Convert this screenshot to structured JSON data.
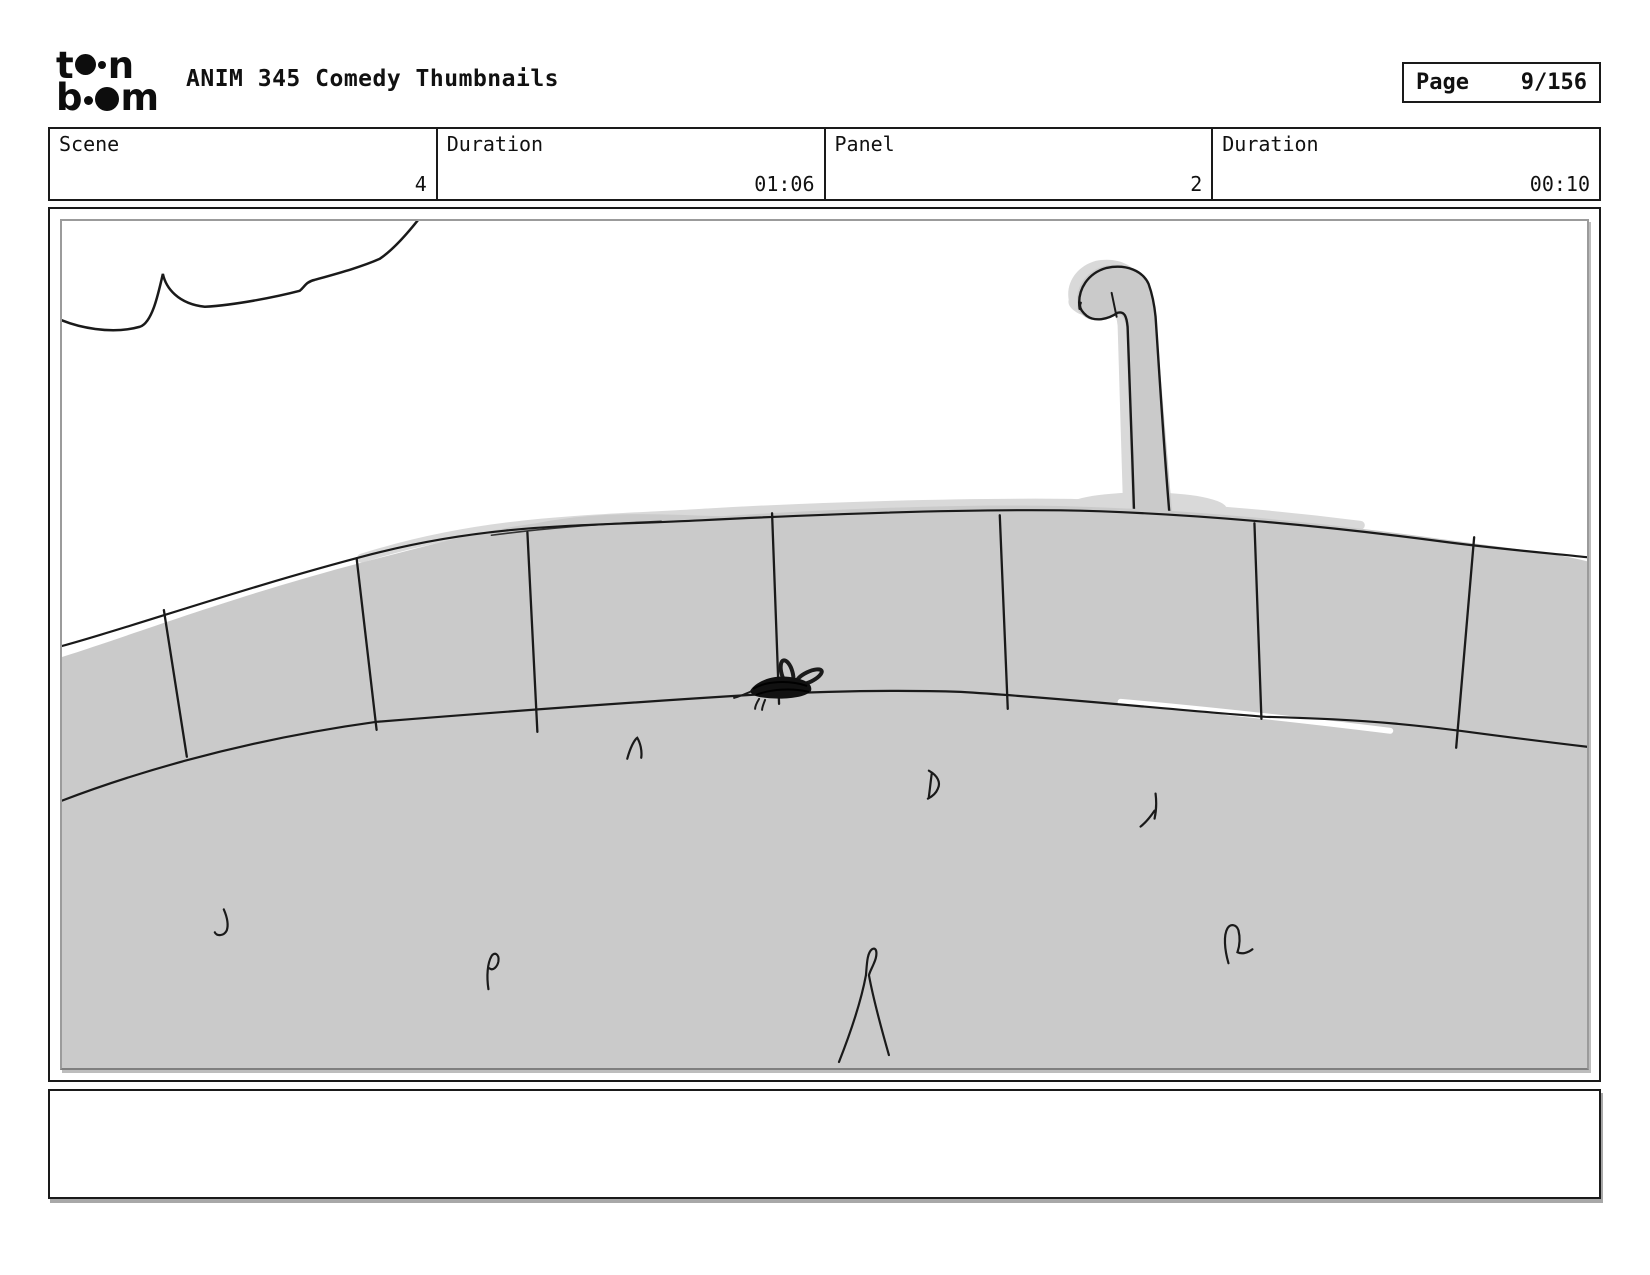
{
  "header": {
    "logo": {
      "row1_left": "t",
      "row1_right": "n",
      "row2_left": "b",
      "row2_right": "m"
    },
    "title": "ANIM 345 Comedy Thumbnails",
    "page_label": "Page",
    "page_value": "9/156"
  },
  "info_row": {
    "cells": [
      {
        "label": "Scene",
        "value": "4"
      },
      {
        "label": "Duration",
        "value": "01:06"
      },
      {
        "label": "Panel",
        "value": "2"
      },
      {
        "label": "Duration",
        "value": "00:10"
      }
    ]
  },
  "panel": {
    "caption": "",
    "drawing_elements": [
      "cloud-outline-top-left",
      "grassy-mound-with-rim-band",
      "rim-divider-lines",
      "hooked-periscope-pole",
      "small-bug-on-rim",
      "grass-tufts"
    ]
  },
  "colors": {
    "ink": "#1a1a1a",
    "hill_gray": "#cacaca",
    "smudge_gray": "#d9d9d9",
    "frame_gray": "#9b9b9b",
    "shadow_gray": "#a8a8a8",
    "paper_white": "#ffffff"
  }
}
